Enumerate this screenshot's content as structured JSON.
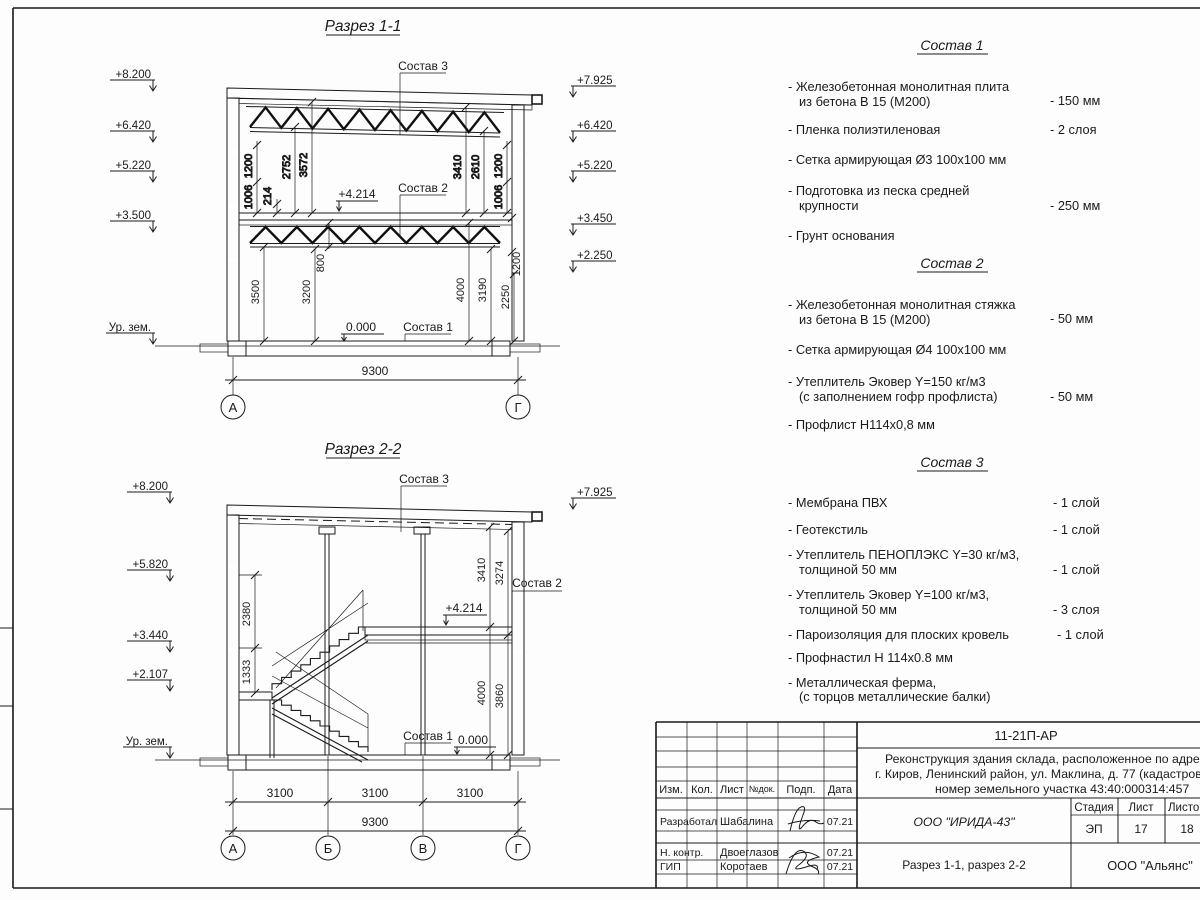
{
  "s1": {
    "title": "Разрез 1-1",
    "elev_left": [
      "+8.200",
      "+6.420",
      "+5.220",
      "+3.500",
      "Ур. зем."
    ],
    "elev_right": [
      "+7.925",
      "+6.420",
      "+5.220",
      "+3.450",
      "+2.250"
    ],
    "callouts": [
      "Состав 3",
      "Состав 2",
      "Состав 1"
    ],
    "levels": [
      "+4.214",
      "0.000"
    ],
    "vdims": [
      "1200",
      "1006",
      "214",
      "2752",
      "3572",
      "3410",
      "2610",
      "1200",
      "1006",
      "800",
      "3500",
      "3200",
      "4000",
      "3190",
      "2250",
      "1200"
    ],
    "total": "9300",
    "axes": [
      "А",
      "Г"
    ]
  },
  "s2": {
    "title": "Разрез 2-2",
    "elev_left": [
      "+8.200",
      "+5.820",
      "+3.440",
      "+2.107",
      "Ур. зем."
    ],
    "elev_right": [
      "+7.925"
    ],
    "callouts": [
      "Состав 3",
      "Состав 2",
      "Состав 1"
    ],
    "levels": [
      "+4.214",
      "0.000"
    ],
    "vdims": [
      "2380",
      "1333",
      "3410",
      "3274",
      "4000",
      "3860"
    ],
    "bdims": [
      "3100",
      "3100",
      "3100"
    ],
    "total": "9300",
    "axes": [
      "А",
      "Б",
      "В",
      "Г"
    ]
  },
  "lists": [
    {
      "title": "Состав 1",
      "items": [
        {
          "l1": "- Железобетонная  монолитная плита",
          "l2": "из бетона В 15 (М200)",
          "v": "- 150 мм"
        },
        {
          "l1": "- Пленка полиэтиленовая",
          "v": "-  2 слоя"
        },
        {
          "l1": "- Сетка армирующая Ø3 100х100 мм",
          "v": ""
        },
        {
          "l1": "- Подготовка из песка средней",
          "l2": "крупности",
          "v": "- 250 мм"
        },
        {
          "l1": "- Грунт основания",
          "v": ""
        }
      ]
    },
    {
      "title": "Состав 2",
      "items": [
        {
          "l1": "- Железобетонная  монолитная стяжка",
          "l2": "из бетона В 15 (М200)",
          "v": "- 50 мм"
        },
        {
          "l1": "- Сетка армирующая Ø4 100х100 мм",
          "v": ""
        },
        {
          "l1": "- Утеплитель Эковер Y=150 кг/м3",
          "l2": "(с заполнением гофр профлиста)",
          "v": "- 50 мм"
        },
        {
          "l1": "- Профлист Н114х0,8 мм",
          "v": ""
        }
      ]
    },
    {
      "title": "Состав 3",
      "items": [
        {
          "l1": "- Мембрана ПВХ",
          "v": "- 1 слой"
        },
        {
          "l1": "- Геотекстиль",
          "v": "- 1 слой"
        },
        {
          "l1": "- Утеплитель ПЕНОПЛЭКС Y=30 кг/м3,",
          "l2": "толщиной 50 мм",
          "v": "- 1 слой"
        },
        {
          "l1": "- Утеплитель Эковер Y=100 кг/м3,",
          "l2": "толщиной 50 мм",
          "v": "- 3 слоя"
        },
        {
          "l1": "- Пароизоляция для плоских кровель",
          "v": "- 1 слой"
        },
        {
          "l1": "- Профнастил Н 114х0.8 мм",
          "v": ""
        },
        {
          "l1": "- Металлическая ферма,",
          "l2": "(с торцов металлические балки)",
          "v": ""
        }
      ]
    }
  ],
  "tb": {
    "code": "11-21П-АР",
    "project": [
      "Реконструкция здания склада, расположенное по адрес",
      "г. Киров, Ленинский район, ул. Маклина, д. 77 (кадастров",
      "номер земельного участка 43:40:000314:457"
    ],
    "cols": [
      "Изм.",
      "Кол.",
      "Лист",
      "№док.",
      "Подп.",
      "Дата"
    ],
    "sig_rows": [
      {
        "role": "Разработал",
        "name": "Шабалина",
        "date": "07.21"
      },
      {
        "role": "Н. контр.",
        "name": "Двоеглазов",
        "date": "07.21"
      },
      {
        "role": "ГИП",
        "name": "Коротаев",
        "date": "07.21"
      }
    ],
    "org": "ООО \"ИРИДА-43\"",
    "stage_label": "Стадия",
    "sheet_label": "Лист",
    "sheets_label": "Листов",
    "stage": "ЭП",
    "sheet_no": "17",
    "sheets_total": "18",
    "doc_title": "Разрез 1-1, разрез 2-2",
    "company": "ООО \"Альянс\""
  }
}
